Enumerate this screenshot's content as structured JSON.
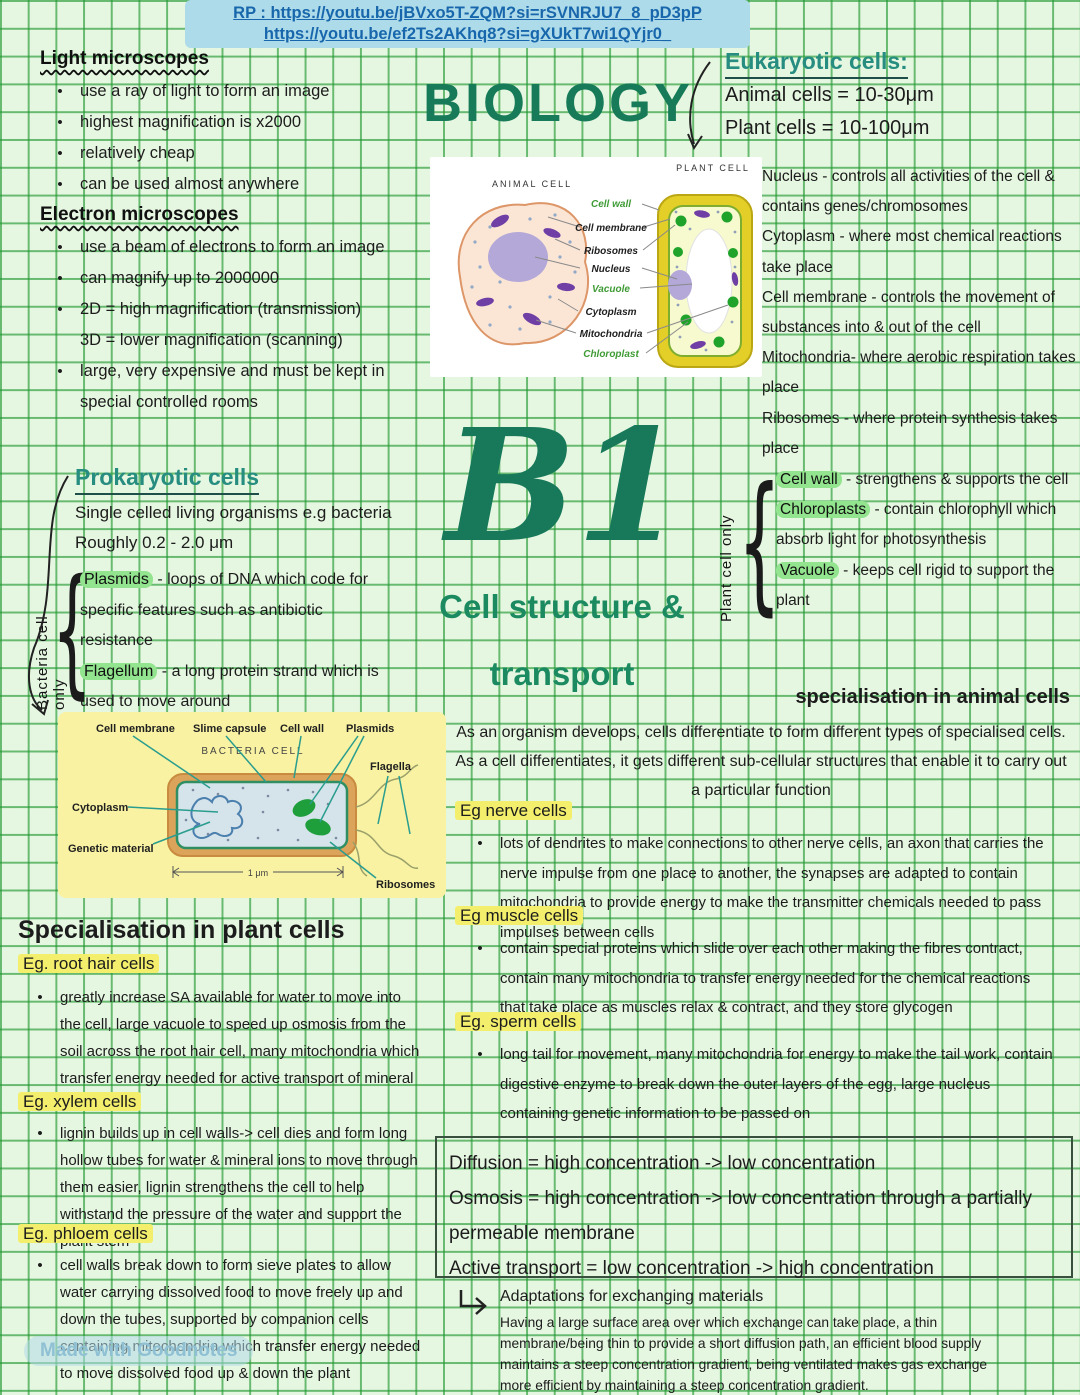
{
  "colors": {
    "title_green": "#17795a",
    "teal_heading": "#2a9186",
    "highlight_yellow": "#f3ef6d",
    "highlight_green": "#93e48e",
    "link_blue": "#1867ac",
    "grid_green": "#2f9e3c"
  },
  "banner": {
    "line1": "RP : https://youtu.be/jBVxo5T-ZQM?si=rSVNRJU7_8_pD3pP",
    "line2": "https://youtu.be/ef2Ts2AKhq8?si=gXUkT7wi1QYjr0_"
  },
  "title": "BIOLOGY",
  "unit": {
    "code": "B1",
    "subtitle1": "Cell structure &",
    "subtitle2": "transport"
  },
  "micro": {
    "light": {
      "heading": "Light microscopes",
      "items": [
        "use a ray of light to form an image",
        "highest magnification is x2000",
        "relatively cheap",
        "can be used almost anywhere"
      ]
    },
    "electron": {
      "heading": "Electron microscopes",
      "items": [
        "use a beam of electrons to form an image",
        "can magnify up to 2000000",
        "2D = high magnification (transmission)",
        "3D = lower magnification (scanning)",
        "large, very expensive and must be kept in special controlled rooms"
      ]
    }
  },
  "eukaryotic": {
    "heading": "Eukaryotic cells:",
    "animal": "Animal cells = 10-30μm",
    "plant": "Plant cells = 10-100μm",
    "organelles": [
      "Nucleus - controls all activities of the cell & contains genes/chromosomes",
      "Cytoplasm - where most chemical reactions take place",
      "Cell membrane - controls the movement of substances into & out of the cell",
      "Mitochondria- where aerobic respiration takes place",
      "Ribosomes - where protein synthesis takes place"
    ]
  },
  "plant_only": {
    "label": "Plant cell only",
    "items": [
      {
        "term": "Cell wall",
        "rest": " - strengthens & supports the cell"
      },
      {
        "term": "Chloroplasts",
        "rest": " - contain chlorophyll which absorb light for photosynthesis"
      },
      {
        "term": "Vacuole",
        "rest": " - keeps cell rigid to support the plant"
      }
    ]
  },
  "prokaryotic": {
    "heading": "Prokaryotic cells",
    "line1": "Single celled living organisms e.g bacteria",
    "line2": "Roughly 0.2 - 2.0 μm",
    "label": "Bacteria cell only",
    "items": [
      {
        "term": "Plasmids",
        "rest": " - loops of DNA which code for specific features such as antibiotic resistance"
      },
      {
        "term": "Flagellum",
        "rest": " - a long protein strand which is used to move around"
      }
    ]
  },
  "cell_diagram": {
    "animal_title": "ANIMAL CELL",
    "plant_title": "PLANT CELL",
    "labels": {
      "cell_wall": "Cell wall",
      "cell_membrane": "Cell membrane",
      "ribosomes": "Ribosomes",
      "nucleus": "Nucleus",
      "vacuole": "Vacuole",
      "cytoplasm": "Cytoplasm",
      "mitochondria": "Mitochondria",
      "chloroplast": "Chloroplast"
    }
  },
  "bacteria_diagram": {
    "title": "BACTERIA CELL",
    "labels": {
      "cell_membrane": "Cell membrane",
      "slime_capsule": "Slime capsule",
      "cell_wall": "Cell wall",
      "plasmids": "Plasmids",
      "flagella": "Flagella",
      "cytoplasm": "Cytoplasm",
      "genetic_material": "Genetic material",
      "ribosomes": "Ribosomes",
      "scale": "1 μm"
    }
  },
  "animal_spec": {
    "heading": "specialisation in animal cells",
    "intro": "As an organism develops, cells differentiate to form different types of specialised cells. As a cell differentiates, it gets different sub-cellular structures that enable it to carry out a particular function",
    "sections": [
      {
        "title": "Eg nerve cells",
        "body": "lots of dendrites to make connections to other nerve cells, an axon that carries the nerve impulse from one place to another, the synapses are adapted to contain mitochondria to provide energy to make the transmitter chemicals needed to pass impulses between cells"
      },
      {
        "title": "Eg muscle cells",
        "body": "contain special proteins which slide over each other making the fibres contract, contain many mitochondria to transfer energy needed for the chemical reactions that take place as muscles relax & contract, and they store glycogen"
      },
      {
        "title": "Eg. sperm cells",
        "body": "long tail for movement, many mitochondria for energy to make the tail work, contain digestive enzyme to break down the outer layers of the egg, large nucleus containing genetic information to be passed on"
      }
    ]
  },
  "transport_box": {
    "line1": "Diffusion = high concentration -> low concentration",
    "line2": "Osmosis = high concentration -> low concentration through a partially permeable membrane",
    "line3": "Active transport = low concentration -> high concentration"
  },
  "adaptations": {
    "heading": "Adaptations for exchanging materials",
    "body": "Having a large surface area over which exchange can take place, a thin membrane/being thin to provide a short diffusion path, an efficient blood supply maintains a steep concentration gradient, being ventilated makes gas exchange more efficient by maintaining a steep concentration gradient."
  },
  "plant_spec": {
    "heading": "Specialisation in plant cells",
    "sections": [
      {
        "title": "Eg. root hair cells",
        "body": "greatly increase SA available for water to move into the cell, large vacuole to speed up osmosis from the soil across the root hair cell, many mitochondria which transfer energy needed for active transport of mineral ions"
      },
      {
        "title": "Eg. xylem cells",
        "body": "lignin builds up in cell walls-> cell dies and form long hollow tubes for water & mineral ions to move through them easier, lignin strengthens the cell to help withstand the pressure of the water and support the plant stem"
      },
      {
        "title": "Eg. phloem cells",
        "body": "cell walls break down to form sieve plates to allow water carrying dissolved food to move freely up and down the tubes, supported by companion cells containing mitochondria which transfer energy needed to move dissolved food up & down the plant"
      }
    ]
  },
  "watermark": "Made with Goodnotes"
}
